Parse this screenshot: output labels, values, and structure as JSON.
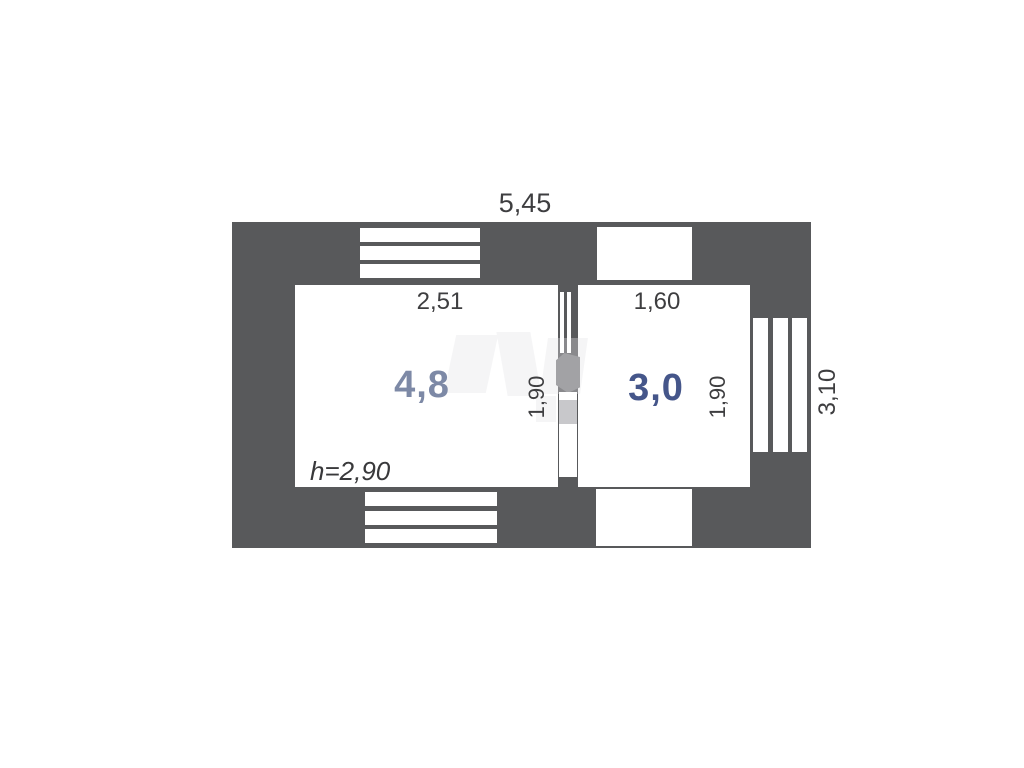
{
  "plan": {
    "dimensions": {
      "overall_width": "5,45",
      "overall_depth": "3,10",
      "ceiling_height": "h=2,90"
    },
    "rooms": [
      {
        "area": "4,8",
        "width": "2,51",
        "depth": "1,90"
      },
      {
        "area": "3,0",
        "width": "1,60",
        "depth": "1,90"
      }
    ],
    "colors": {
      "wall": "#58595b",
      "dimension_text": "#3e3e40",
      "room1_area_text": "#7d89a6",
      "room2_area_text": "#45568a",
      "door_leaf": "#a2a2a5",
      "background": "#ffffff"
    }
  }
}
